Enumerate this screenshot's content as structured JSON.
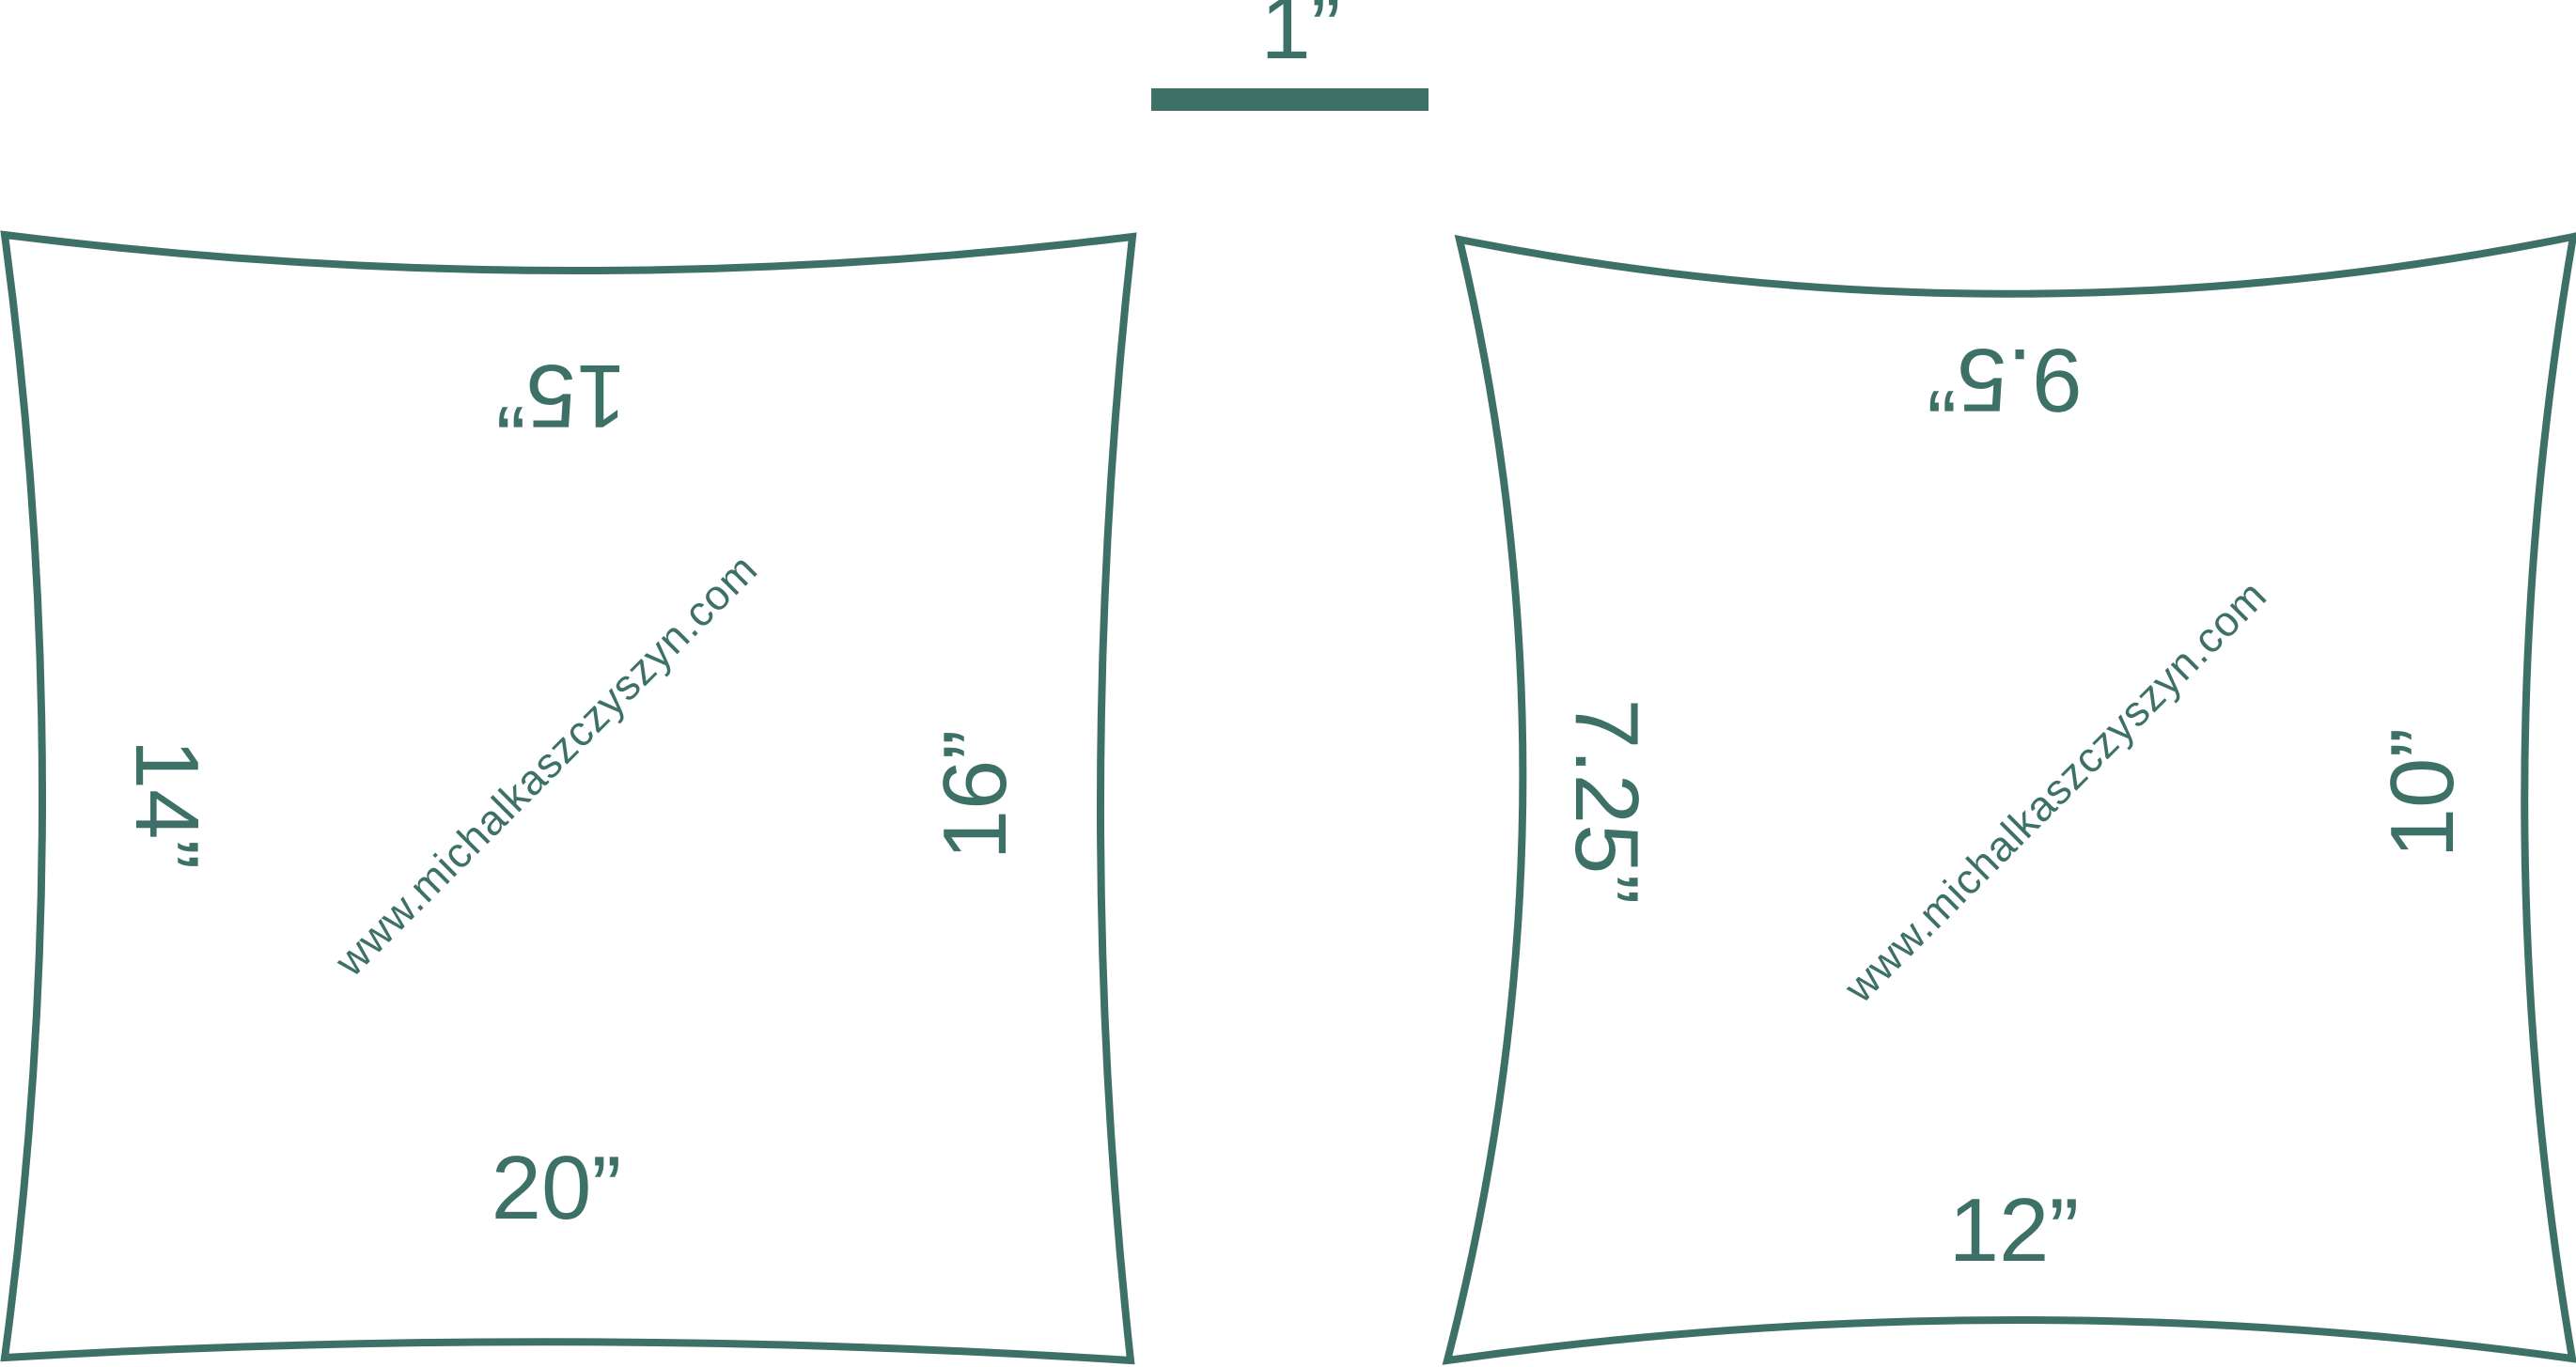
{
  "colors": {
    "accent": "#3D7168",
    "background": "#FFFFFF"
  },
  "scale": {
    "label": "1”"
  },
  "pieces": [
    {
      "id": "left-piece",
      "watermark": "www.michalkaszczyszyn.com",
      "sides": {
        "top": "15”",
        "left": "14”",
        "right": "16”",
        "bottom": "20”"
      }
    },
    {
      "id": "right-piece",
      "watermark": "www.michalkaszczyszyn.com",
      "sides": {
        "top": "9.5”",
        "left": "7.25”",
        "right": "10”",
        "bottom": "12”"
      }
    }
  ]
}
